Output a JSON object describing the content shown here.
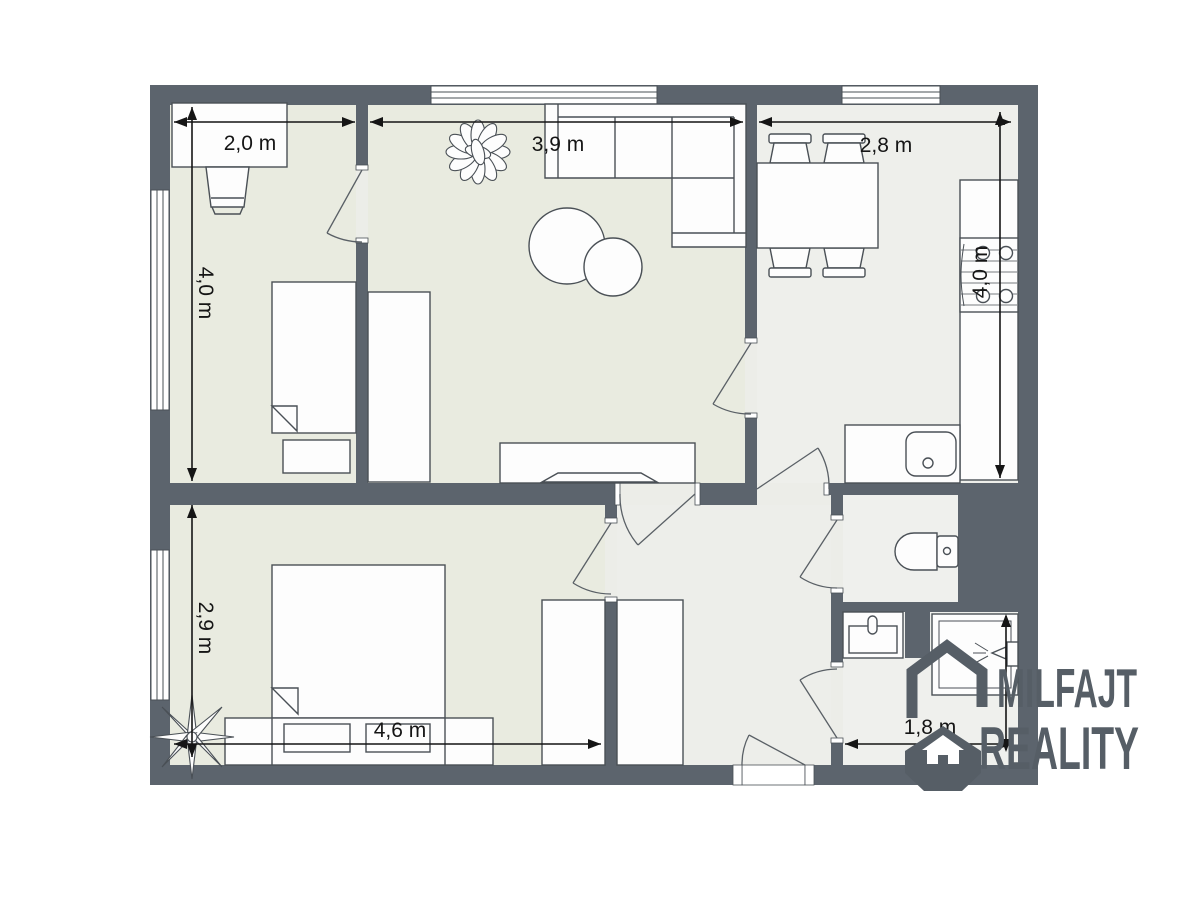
{
  "title": "Apartment floor plan",
  "branding": {
    "line1": "MILFAJT",
    "line2": "REALITY",
    "icon": "house-in-octagon-icon",
    "logo_color": "#565e66"
  },
  "dimensions": {
    "room_top_left_width": "2,0 m",
    "room_top_left_height": "4,0 m",
    "living_room_width": "3,9 m",
    "kitchen_width": "2,8 m",
    "kitchen_height": "4,0 m",
    "bedroom_height": "2,9 m",
    "bedroom_width": "4,6 m",
    "bathroom_width": "1,8 m"
  },
  "colors": {
    "wall": "#5c646d",
    "floor_room": "#e9ebe0",
    "floor_kitchen": "#eeefeb",
    "floor_hall": "#edeeea",
    "floor_wet": "#eff0ed",
    "floor_base": "#ecede8",
    "dimension_line": "#151515",
    "furniture_outline": "#4a5056",
    "furniture_fill": "#fdfdfd"
  }
}
